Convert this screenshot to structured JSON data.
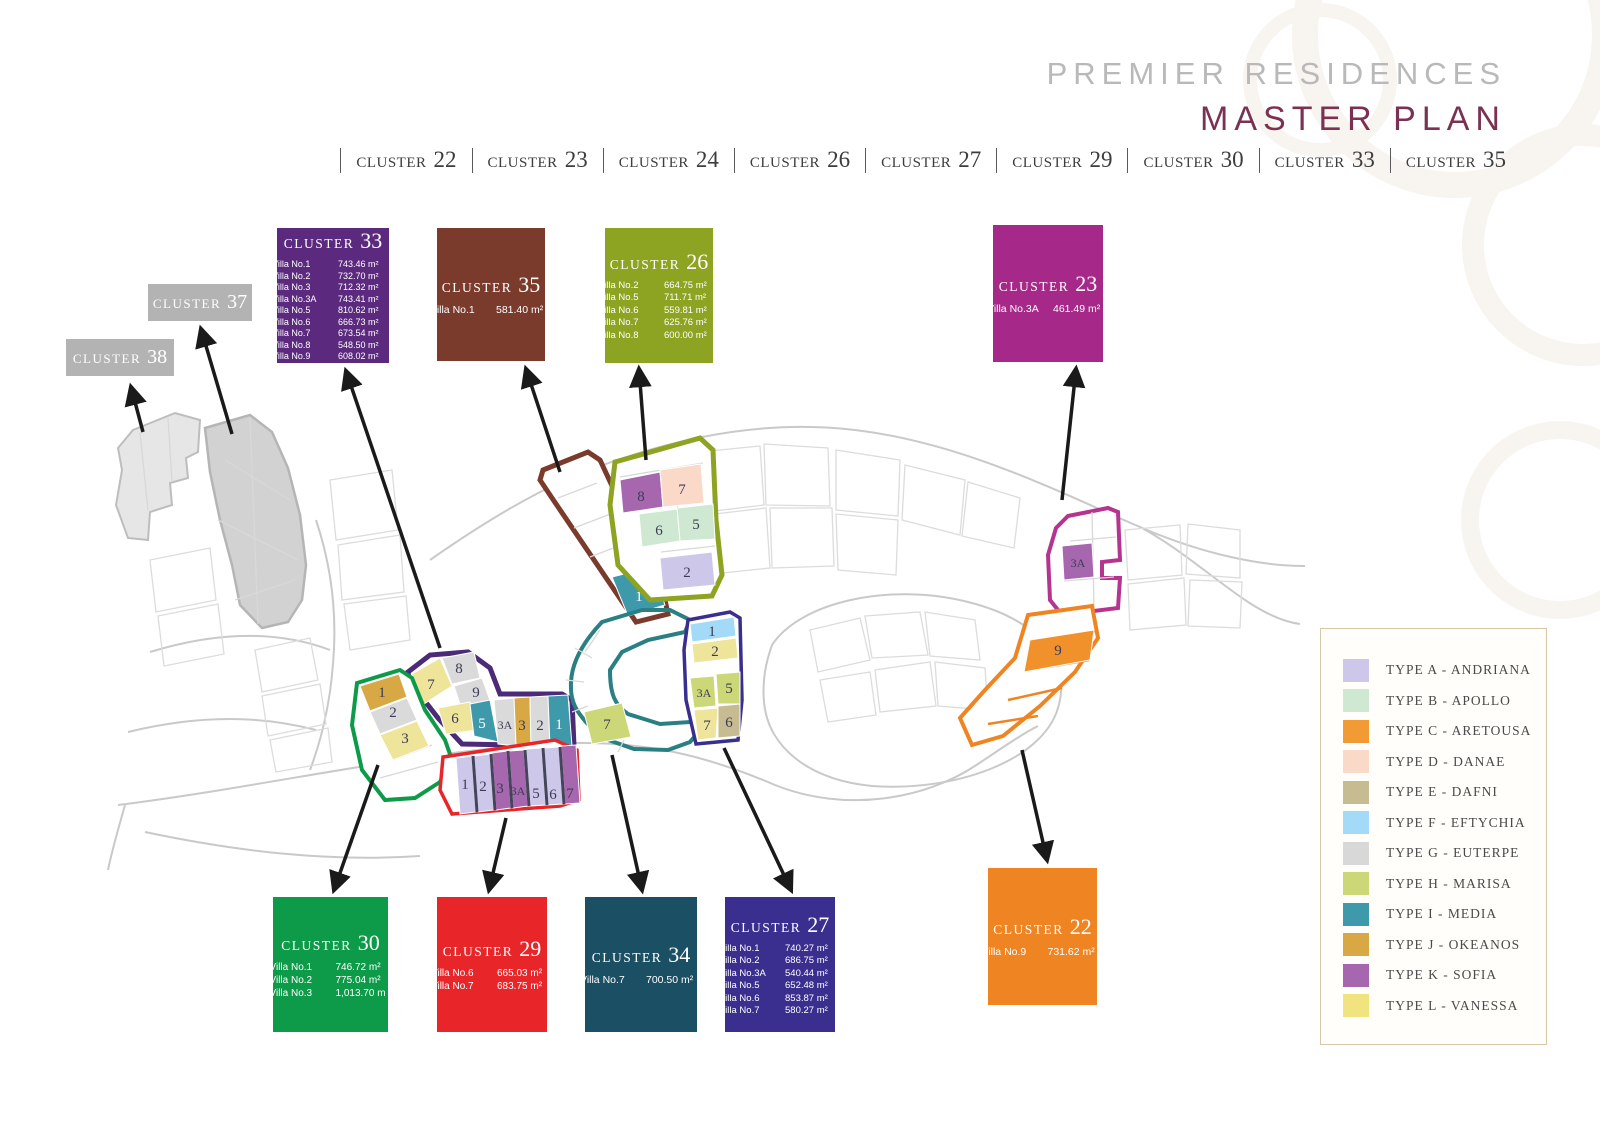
{
  "header": {
    "line1": "PREMIER RESIDENCES",
    "line2": "MASTER PLAN"
  },
  "nav": {
    "items": [
      {
        "word": "CLUSTER",
        "num": "22"
      },
      {
        "word": "CLUSTER",
        "num": "23"
      },
      {
        "word": "CLUSTER",
        "num": "24"
      },
      {
        "word": "CLUSTER",
        "num": "26"
      },
      {
        "word": "CLUSTER",
        "num": "27"
      },
      {
        "word": "CLUSTER",
        "num": "29"
      },
      {
        "word": "CLUSTER",
        "num": "30"
      },
      {
        "word": "CLUSTER",
        "num": "33"
      },
      {
        "word": "CLUSTER",
        "num": "35"
      }
    ]
  },
  "boxes": {
    "c33": {
      "word": "CLUSTER",
      "num": "33",
      "color": "#5b2a7e",
      "villas": [
        {
          "name": "Villa No.1",
          "area": "743.46 m²"
        },
        {
          "name": "Villa No.2",
          "area": "732.70 m²"
        },
        {
          "name": "Villa No.3",
          "area": "712.32 m²"
        },
        {
          "name": "Villa No.3A",
          "area": "743.41 m²"
        },
        {
          "name": "Villa No.5",
          "area": "810.62 m²"
        },
        {
          "name": "Villa No.6",
          "area": "666.73 m²"
        },
        {
          "name": "Villa No.7",
          "area": "673.54 m²"
        },
        {
          "name": "Villa No.8",
          "area": "548.50 m²"
        },
        {
          "name": "Villa No.9",
          "area": "608.02 m²"
        }
      ]
    },
    "c35": {
      "word": "CLUSTER",
      "num": "35",
      "color": "#7a3b2c",
      "villas": [
        {
          "name": "Villa No.1",
          "area": "581.40 m²"
        }
      ]
    },
    "c26": {
      "word": "CLUSTER",
      "num": "26",
      "color": "#8da322",
      "villas": [
        {
          "name": "Villa No.2",
          "area": "664.75 m²"
        },
        {
          "name": "Villa No.5",
          "area": "711.71 m²"
        },
        {
          "name": "Villa No.6",
          "area": "559.81 m²"
        },
        {
          "name": "Villa No.7",
          "area": "625.76 m²"
        },
        {
          "name": "Villa No.8",
          "area": "600.00 m²"
        }
      ]
    },
    "c23": {
      "word": "CLUSTER",
      "num": "23",
      "color": "#a62888",
      "villas": [
        {
          "name": "Villa No.3A",
          "area": "461.49 m²"
        }
      ]
    },
    "c37": {
      "word": "CLUSTER",
      "num": "37",
      "color": "#b3b3b3",
      "villas": []
    },
    "c38": {
      "word": "CLUSTER",
      "num": "38",
      "color": "#b3b3b3",
      "villas": []
    },
    "c30": {
      "word": "CLUSTER",
      "num": "30",
      "color": "#0d9b49",
      "villas": [
        {
          "name": "Villa No.1",
          "area": "746.72 m²"
        },
        {
          "name": "Villa No.2",
          "area": "775.04 m²"
        },
        {
          "name": "Villa No.3",
          "area": "1,013.70 m"
        }
      ]
    },
    "c29": {
      "word": "CLUSTER",
      "num": "29",
      "color": "#e8262a",
      "villas": [
        {
          "name": "Villa No.6",
          "area": "665.03 m²"
        },
        {
          "name": "Villa No.7",
          "area": "683.75 m²"
        }
      ]
    },
    "c34": {
      "word": "CLUSTER",
      "num": "34",
      "color": "#1b4f63",
      "villas": [
        {
          "name": "Villa No.7",
          "area": "700.50 m²"
        }
      ]
    },
    "c27": {
      "word": "CLUSTER",
      "num": "27",
      "color": "#3a2f8f",
      "villas": [
        {
          "name": "Villa No.1",
          "area": "740.27 m²"
        },
        {
          "name": "Villa No.2",
          "area": "686.75 m²"
        },
        {
          "name": "Villa No.3A",
          "area": "540.44 m²"
        },
        {
          "name": "Villa No.5",
          "area": "652.48 m²"
        },
        {
          "name": "Villa No.6",
          "area": "853.87 m²"
        },
        {
          "name": "Villa No.7",
          "area": "580.27 m²"
        }
      ]
    },
    "c22": {
      "word": "CLUSTER",
      "num": "22",
      "color": "#ef8423",
      "villas": [
        {
          "name": "Villa No.9",
          "area": "731.62 m²"
        }
      ]
    }
  },
  "legend": {
    "items": [
      {
        "label": "TYPE A - ANDRIANA",
        "color": "#cdc8ea"
      },
      {
        "label": "TYPE B - APOLLO",
        "color": "#cfe8d2"
      },
      {
        "label": "TYPE C - ARETOUSA",
        "color": "#f29a33"
      },
      {
        "label": "TYPE D - DANAE",
        "color": "#fad9c9"
      },
      {
        "label": "TYPE E - DAFNI",
        "color": "#c7bb92"
      },
      {
        "label": "TYPE F - EFTYCHIA",
        "color": "#a3daf7"
      },
      {
        "label": "TYPE G - EUTERPE",
        "color": "#d8d8d8"
      },
      {
        "label": "TYPE H - MARISA",
        "color": "#ccd878"
      },
      {
        "label": "TYPE I - MEDIA",
        "color": "#3e9aab"
      },
      {
        "label": "TYPE J - OKEANOS",
        "color": "#d8a845"
      },
      {
        "label": "TYPE K - SOFIA",
        "color": "#a667af"
      },
      {
        "label": "TYPE L - VANESSA",
        "color": "#f1e47e"
      }
    ]
  },
  "map": {
    "clusters": {
      "c35": {
        "name": "CLUSTER 35",
        "outline_color": "#7a3b2c",
        "cells": [
          {
            "label": "1",
            "type": "I"
          }
        ]
      },
      "c26": {
        "name": "CLUSTER 26",
        "outline_color": "#8da322",
        "cells": [
          {
            "label": "8",
            "type": "K"
          },
          {
            "label": "7",
            "type": "D"
          },
          {
            "label": "6",
            "type": "B"
          },
          {
            "label": "5",
            "type": "B"
          },
          {
            "label": "2",
            "type": "A"
          }
        ]
      },
      "c23": {
        "name": "CLUSTER 23",
        "outline_color": "#b5348f",
        "cells": [
          {
            "label": "3A",
            "type": "K"
          }
        ]
      },
      "c22": {
        "name": "CLUSTER 22",
        "outline_color": "#ef8423",
        "cells": [
          {
            "label": "9",
            "type": "C"
          }
        ]
      },
      "c33": {
        "name": "CLUSTER 33",
        "outline_color": "#4b2a78",
        "cells": [
          {
            "label": "7",
            "type": "L"
          },
          {
            "label": "8",
            "type": "G"
          },
          {
            "label": "9",
            "type": "G"
          },
          {
            "label": "6",
            "type": "L"
          },
          {
            "label": "5",
            "type": "I"
          },
          {
            "label": "3A",
            "type": "G"
          },
          {
            "label": "3",
            "type": "J"
          },
          {
            "label": "2",
            "type": "G"
          },
          {
            "label": "1",
            "type": "I"
          }
        ]
      },
      "c30": {
        "name": "CLUSTER 30",
        "outline_color": "#0d9b49",
        "cells": [
          {
            "label": "1",
            "type": "J"
          },
          {
            "label": "2",
            "type": "G"
          },
          {
            "label": "3",
            "type": "L"
          }
        ]
      },
      "c29": {
        "name": "CLUSTER 29",
        "outline_color": "#e8262a",
        "cells": [
          {
            "label": "1",
            "type": "A"
          },
          {
            "label": "2",
            "type": "A"
          },
          {
            "label": "3",
            "type": "K"
          },
          {
            "label": "3A",
            "type": "K"
          },
          {
            "label": "5",
            "type": "A"
          },
          {
            "label": "6",
            "type": "A"
          },
          {
            "label": "7",
            "type": "K"
          }
        ]
      },
      "c34": {
        "name": "CLUSTER 34",
        "outline_color": "#2a7f83",
        "cells": [
          {
            "label": "7",
            "type": "H"
          }
        ]
      },
      "c27": {
        "name": "CLUSTER 27",
        "outline_color": "#3a2f8f",
        "cells": [
          {
            "label": "1",
            "type": "F"
          },
          {
            "label": "2",
            "type": "L"
          },
          {
            "label": "3A",
            "type": "H"
          },
          {
            "label": "5",
            "type": "H"
          },
          {
            "label": "7",
            "type": "L"
          },
          {
            "label": "6",
            "type": "E"
          }
        ]
      }
    }
  }
}
